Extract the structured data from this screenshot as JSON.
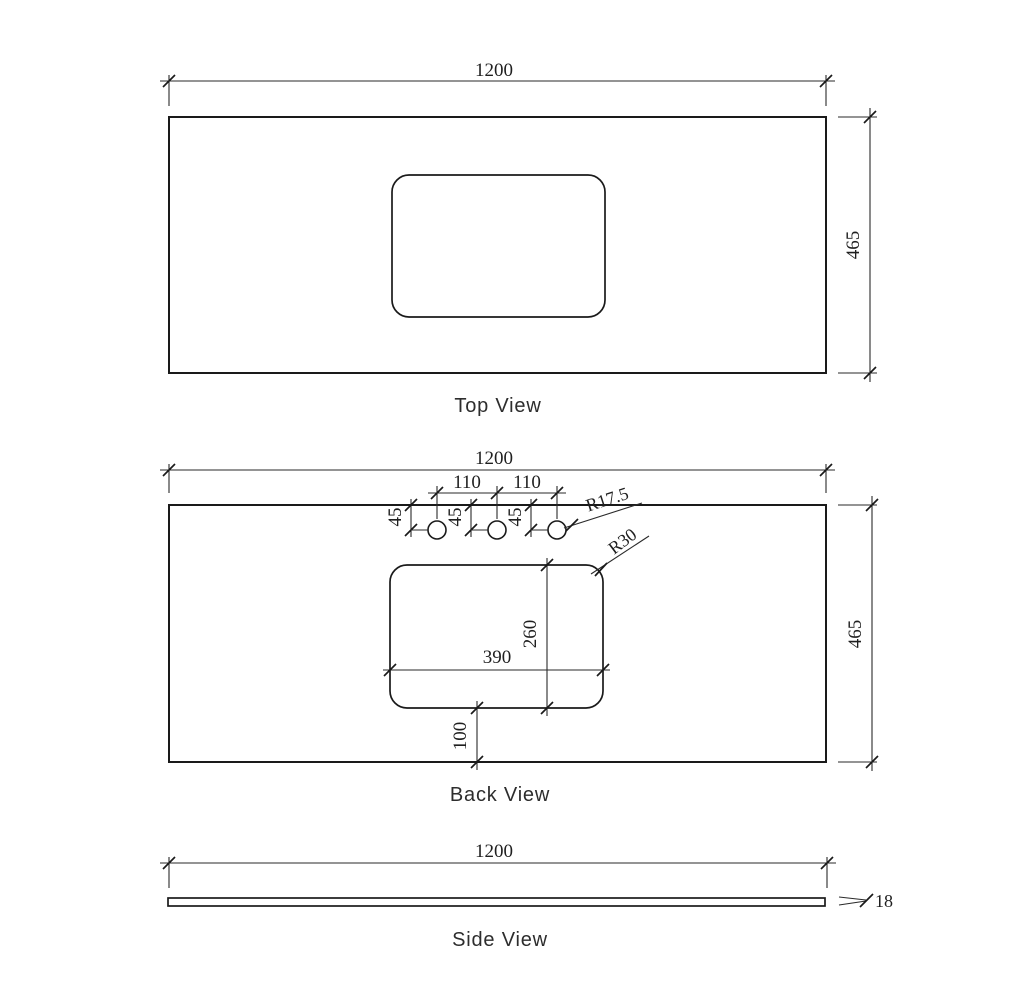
{
  "drawing": {
    "background": "#ffffff",
    "line_color": "#1a1a1a",
    "views": {
      "top": {
        "label": "Top View",
        "width": "1200",
        "depth": "465"
      },
      "back": {
        "label": "Back View",
        "width": "1200",
        "depth": "465",
        "hole_spacing_left": "110",
        "hole_spacing_right": "110",
        "hole_offset_1": "45",
        "hole_offset_2": "45",
        "hole_offset_3": "45",
        "hole_radius": "R17.5",
        "cutout_corner_radius": "R30",
        "cutout_width": "390",
        "cutout_depth": "260",
        "cutout_bottom_offset": "100"
      },
      "side": {
        "label": "Side View",
        "width": "1200",
        "thickness": "18"
      }
    }
  }
}
